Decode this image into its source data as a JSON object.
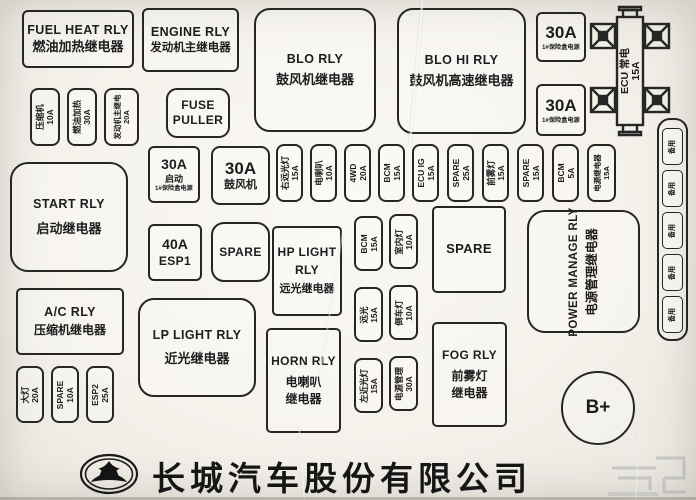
{
  "diagram": {
    "company": "长城汽车股份有限公司",
    "battery_label": "B+"
  },
  "colors": {
    "line": "#262626",
    "paper": "#f7f4ee"
  },
  "relays": {
    "fuel_heat": {
      "en": "FUEL HEAT RLY",
      "zh": "燃油加热继电器"
    },
    "engine": {
      "en": "ENGINE RLY",
      "zh": "发动机主继电器"
    },
    "blo": {
      "en": "BLO RLY",
      "zh": "鼓风机继电器"
    },
    "blo_hi": {
      "en": "BLO HI RLY",
      "zh": "鼓风机高速继电器"
    },
    "start": {
      "en": "START RLY",
      "zh": "启动继电器"
    },
    "hp_light": {
      "en1": "HP LIGHT",
      "en2": "RLY",
      "zh": "远光继电器"
    },
    "lp_light": {
      "en": "LP LIGHT RLY",
      "zh": "近光继电器"
    },
    "ac": {
      "en": "A/C RLY",
      "zh": "压缩机继电器"
    },
    "horn": {
      "en": "HORN RLY",
      "zh1": "电喇叭",
      "zh2": "继电器"
    },
    "fog": {
      "en": "FOG RLY",
      "zh1": "前雾灯",
      "zh2": "继电器"
    },
    "power_manage": {
      "en": "POWER MANAGE RLY",
      "zh": "电源管理继电器"
    }
  },
  "slots": {
    "fuse_puller": {
      "l1": "FUSE",
      "l2": "PULLER"
    },
    "spare_small": "SPARE",
    "spare_large": "SPARE",
    "f30_power1": {
      "amp": "30A",
      "sub": "1#保险盒电源"
    },
    "f30_power2": {
      "amp": "30A",
      "sub": "1#保险盒电源"
    },
    "ecu_main": {
      "l1": "ECU 常电",
      "l2": "15A"
    },
    "f30_start": {
      "amp": "30A",
      "name": "启动",
      "sub": "1#保险盒电源"
    },
    "f30_blower": {
      "amp": "30A",
      "name": "鼓风机"
    },
    "f40_esp1": {
      "amp": "40A",
      "name": "ESP1"
    }
  },
  "strips": {
    "left_top": [
      {
        "label": "压缩机",
        "amp": "10A"
      },
      {
        "label": "燃油加热",
        "amp": "30A"
      },
      {
        "label": "发动机主继电",
        "amp": "20A"
      }
    ],
    "mid": [
      {
        "label": "右远光灯",
        "amp": "15A"
      },
      {
        "label": "电喇叭",
        "amp": "10A"
      },
      {
        "label": "4WD",
        "amp": "20A"
      },
      {
        "label": "BCM",
        "amp": "15A"
      },
      {
        "label": "ECU IG",
        "amp": "15A"
      },
      {
        "label": "SPARE",
        "amp": "25A"
      },
      {
        "label": "前雾灯",
        "amp": "15A"
      },
      {
        "label": "SPARE",
        "amp": "15A"
      },
      {
        "label": "BCM",
        "amp": "5A"
      },
      {
        "label": "电源继电器",
        "amp": "15A"
      }
    ],
    "center": [
      {
        "label": "BCM",
        "amp": "15A"
      },
      {
        "label": "室内灯",
        "amp": "10A"
      },
      {
        "label": "远光",
        "amp": "15A"
      },
      {
        "label": "倒车灯",
        "amp": "10A"
      },
      {
        "label": "左近光灯",
        "amp": "15A"
      },
      {
        "label": "电源管理",
        "amp": "30A"
      }
    ],
    "left_bottom": [
      {
        "label": "大灯",
        "amp": "20A"
      },
      {
        "label": "SPARE",
        "amp": "10A"
      },
      {
        "label": "ESP2",
        "amp": "25A"
      }
    ],
    "right_col": [
      {
        "label": "备用"
      },
      {
        "label": "备用"
      },
      {
        "label": "备用"
      },
      {
        "label": "备用"
      },
      {
        "label": "备用"
      }
    ]
  }
}
